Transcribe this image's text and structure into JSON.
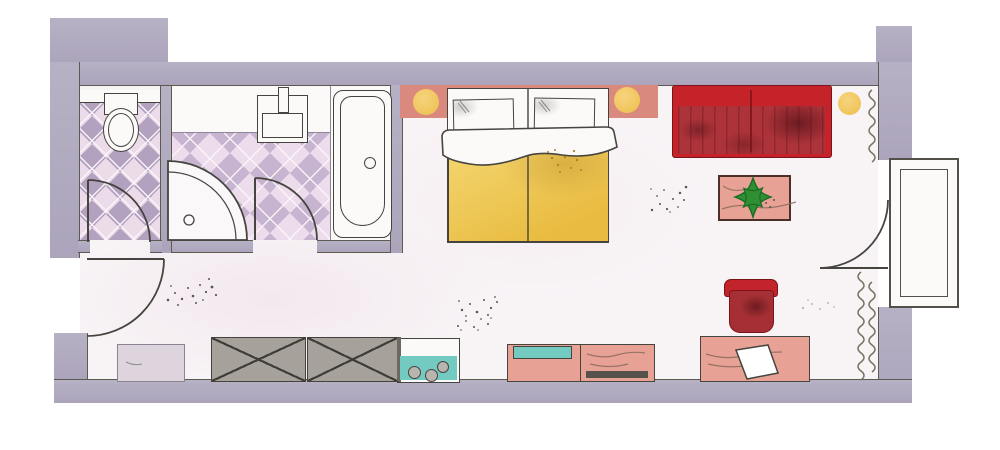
{
  "canvas": {
    "width": 1000,
    "height": 450
  },
  "scene": {
    "type": "floor-plan",
    "description": "hand-drawn top-down floor plan of a hotel studio room with bathroom, WC, bedroom-living area and balcony door",
    "rooms": [
      "wc",
      "bathroom",
      "entry-hall",
      "bedroom-living"
    ],
    "fixtures": [
      "toilet",
      "washbasin",
      "corner-shower",
      "bathtub"
    ],
    "furniture": [
      "double-bed",
      "pillows",
      "duvet",
      "headboard-shelf",
      "bedside-lamps",
      "sofa",
      "side-lamp",
      "coffee-table",
      "potted-plant",
      "armchair",
      "desk",
      "desk-paper",
      "sideboard",
      "minibar-unit",
      "wardrobes",
      "luggage-bench"
    ],
    "openings": [
      "entrance-door",
      "wc-door",
      "bathroom-door",
      "balcony-door",
      "balcony-window-frame"
    ],
    "heating": [
      "radiator-top-right",
      "radiator-bottom-right"
    ]
  },
  "colors": {
    "wall": "#b7b1c5",
    "wallDeep": "#aba4bb",
    "wallLine": "#5d5a52",
    "floor": "#f8f4f6",
    "white": "#fcfaf8",
    "outline": "#46443f",
    "grout": "#f6f0f4",
    "tilePink": "#ecdcea",
    "tileMauve": "#b2a1bf",
    "bathPink": "#ecdcec",
    "bathMauve": "#c7b4d0",
    "headboard": "#d9897e",
    "salmon": "#e7a295",
    "lampYellow": "#f0c45a",
    "duvetA": "#f4d671",
    "duvetB": "#e9bc41",
    "sofaRed": "#c62229",
    "sofaSeat": "#ab3339",
    "chairRed": "#c3242b",
    "chairSeat": "#a52f34",
    "teal": "#72cac1",
    "wardrobe": "#a7a19c",
    "wardrobeLine": "#3f3d38",
    "bench": "#ddd4de",
    "plant": "#2e8f33",
    "plantDark": "#1c6b24",
    "zigzag": "#73725f",
    "speckle": "#5a5751",
    "drawerBar": "#55514b",
    "redLine": "#7c1319"
  }
}
